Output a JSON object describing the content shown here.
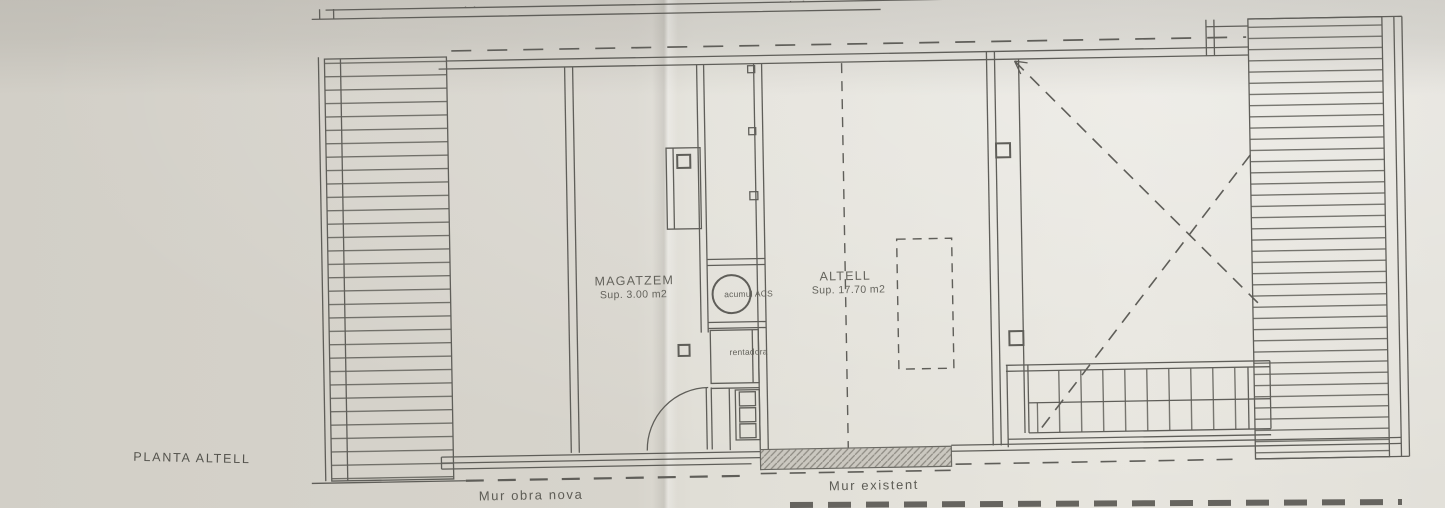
{
  "drawing": {
    "plan_title": "PLANTA ALTELL",
    "rooms": {
      "magatzem": {
        "name": "MAGATZEM",
        "area": "Sup. 3.00 m2"
      },
      "altell": {
        "name": "ALTELL",
        "area": "Sup. 17.70 m2"
      }
    },
    "fixtures": {
      "water_heater": "acumul ACS",
      "washer": "rentadora"
    },
    "legend": {
      "new_wall": "Mur obra nova",
      "existing_wall": "Mur existent"
    }
  },
  "colors": {
    "paper": "#d9d6ce",
    "ink": "#5f5e59",
    "wall_hatch": "#8e8b83"
  }
}
